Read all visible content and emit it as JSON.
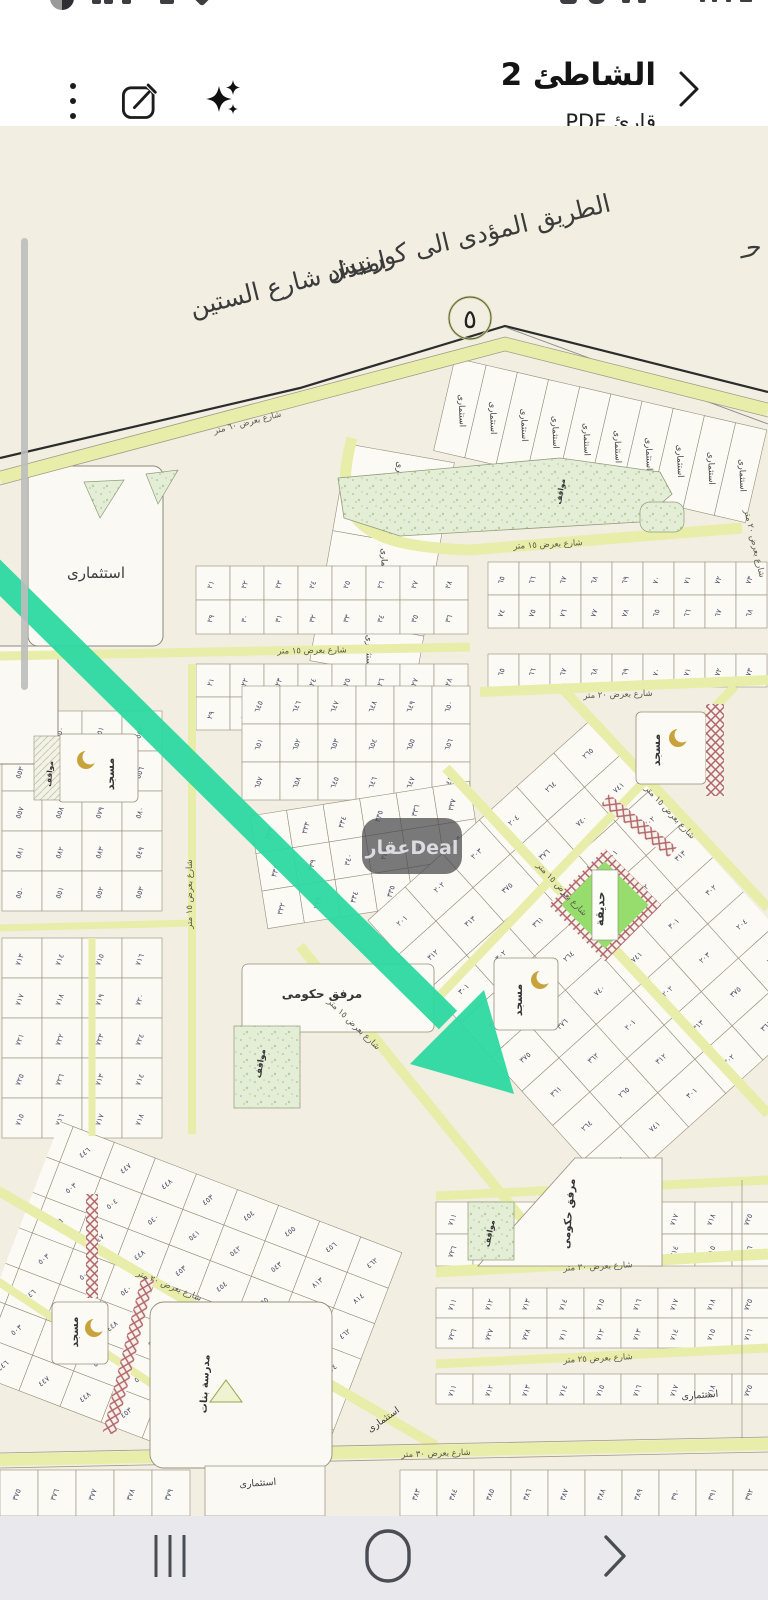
{
  "header": {
    "title": "الشاطئ 2",
    "subtitle": "قارئ PDF",
    "icons": [
      "back-chevron",
      "sparkles-ai",
      "compose-edit",
      "kebab-menu"
    ]
  },
  "bottom_nav": {
    "icons": [
      "recents",
      "home",
      "back"
    ]
  },
  "map": {
    "handwriting": [
      "الطريق المؤدى الى كورنيش",
      "امتداد شارع الستين"
    ],
    "circle_marker": "٥",
    "watermark": "عقارDeal",
    "colors": {
      "paper": "#f2eee1",
      "parcel": "#fbfaf5",
      "parcel_line": "#968e7c",
      "road_yellow": "#e9edaa",
      "park_green": "#e4eed7",
      "garden_green": "#97dd6d",
      "hatch_red": "#b2656c",
      "arrow_green": "#2ed9a1",
      "number_blue": "#4b4f66"
    },
    "labels": [
      {
        "t": "شارع بعرض ٦٠ متر",
        "x": 248,
        "y": 299,
        "r": -14.5,
        "c": "st"
      },
      {
        "t": "شارع بعرض ١٥ متر",
        "x": 548,
        "y": 421,
        "r": -3,
        "c": "st"
      },
      {
        "t": "شارع بعرض ١٥ متر",
        "x": 312,
        "y": 527,
        "r": -1,
        "c": "st"
      },
      {
        "t": "شارع بعرض ٢٠ متر",
        "x": 618,
        "y": 571,
        "r": -2,
        "c": "st"
      },
      {
        "t": "شارع بعرض ١٥ متر",
        "x": 560,
        "y": 765,
        "r": 47,
        "c": "st"
      },
      {
        "t": "شارع بعرض ١٥ متر",
        "x": 668,
        "y": 688,
        "r": 47,
        "c": "st"
      },
      {
        "t": "شارع بعرض ١٥ متر",
        "x": 352,
        "y": 900,
        "r": 44,
        "c": "st"
      },
      {
        "t": "شارع بعرض ١٥ متر",
        "x": 192,
        "y": 768,
        "r": -90,
        "c": "st",
        "s": 7.5
      },
      {
        "t": "شارع بعرض ٢٠ متر",
        "x": 752,
        "y": 418,
        "r": 77,
        "c": "st",
        "s": 7.5
      },
      {
        "t": "شارع بعرض ٣٠ متر",
        "x": 598,
        "y": 1143,
        "r": -3,
        "c": "st"
      },
      {
        "t": "شارع بعرض ٢٥ متر",
        "x": 598,
        "y": 1235,
        "r": -3,
        "c": "st"
      },
      {
        "t": "شارع بعرض ٣٠ متر",
        "x": 436,
        "y": 1330,
        "r": -2,
        "c": "st"
      },
      {
        "t": "شارع بعرض ٢٠ متر",
        "x": 168,
        "y": 1162,
        "r": 22,
        "c": "st"
      },
      {
        "t": "استثمارى",
        "x": 96,
        "y": 452,
        "s": 15,
        "c": "zn"
      },
      {
        "t": "استثمارى",
        "x": 385,
        "y": 1296,
        "s": 9.5,
        "r": -35,
        "c": "zn"
      },
      {
        "t": "استثمارى",
        "x": 258,
        "y": 1360,
        "s": 9.5,
        "r": -4,
        "c": "zn"
      },
      {
        "t": "استثمارى",
        "x": 700,
        "y": 1272,
        "s": 9.5,
        "r": -4,
        "c": "zn"
      },
      {
        "t": "مسجد",
        "x": 114,
        "y": 648,
        "r": -90,
        "s": 11,
        "c": "lm"
      },
      {
        "t": "مواقف",
        "x": 52,
        "y": 648,
        "r": -85,
        "s": 7.5,
        "c": "lm"
      },
      {
        "t": "مسجد",
        "x": 660,
        "y": 624,
        "r": -90,
        "s": 11,
        "c": "lm"
      },
      {
        "t": "مسجد",
        "x": 522,
        "y": 874,
        "r": -90,
        "s": 11,
        "c": "lm"
      },
      {
        "t": "مواقف",
        "x": 563,
        "y": 366,
        "r": -80,
        "s": 7.5,
        "c": "lm"
      },
      {
        "t": "مرفق حكومى",
        "x": 322,
        "y": 872,
        "s": 12,
        "c": "lm"
      },
      {
        "t": "مواقف",
        "x": 263,
        "y": 938,
        "r": -80,
        "s": 8.5,
        "c": "lm"
      },
      {
        "t": "حديقة",
        "x": 604,
        "y": 783,
        "r": -88,
        "s": 11.5,
        "c": "lm"
      },
      {
        "t": "مرفق حكومى",
        "x": 572,
        "y": 1088,
        "r": -85,
        "s": 10.5,
        "c": "lm"
      },
      {
        "t": "مواقف",
        "x": 492,
        "y": 1108,
        "r": -78,
        "s": 8,
        "c": "lm"
      },
      {
        "t": "مدرسة بنات",
        "x": 208,
        "y": 1258,
        "r": -87,
        "s": 10,
        "c": "lm"
      },
      {
        "t": "مسجد",
        "x": 78,
        "y": 1206,
        "r": -90,
        "s": 10.5,
        "c": "lm"
      },
      {
        "t": "حـ",
        "x": 752,
        "y": 130,
        "r": -13,
        "s": 20,
        "c": "hand"
      }
    ],
    "nums": {
      "n2": [
        "٦٥",
        "٦٦",
        "٦٧",
        "٦٨",
        "٦٩",
        "٧٠",
        "٧١",
        "٧٢",
        "٧٣",
        "٧٤",
        "٧٥",
        "٧٦",
        "٧٧",
        "٧٨"
      ],
      "n2b": [
        "٢١",
        "٢٢",
        "٢٣",
        "٢٤",
        "٢٥",
        "٢٦",
        "٢٧",
        "٢٨",
        "٢٩",
        "٣٠",
        "٣١",
        "٣٢",
        "٣٣",
        "٣٤",
        "٣٥",
        "٣٦"
      ],
      "n5": [
        "٥٤٩",
        "٥٥٠",
        "٥٥١",
        "٥٥٢",
        "٥٥٣",
        "٥٥٤",
        "٥٥٥",
        "٥٥٦",
        "٥٥٧",
        "٥٥٨",
        "٥٧٩",
        "٥٨٠",
        "٥٨١",
        "٥٨٢",
        "٥٨٣"
      ],
      "n7": [
        "٧١٣",
        "٧١٤",
        "٧١٥",
        "٧١٦",
        "٧١٧",
        "٧١٨",
        "٧١٩",
        "٧٢٠",
        "٧٢١",
        "٧٢٢",
        "٧٢٣",
        "٧٢٤",
        "٧٢٥",
        "٧٢٦"
      ],
      "n6": [
        "٦٤٥",
        "٦٤٦",
        "٦٤٧",
        "٦٤٨",
        "٦٤٩",
        "٦٥٠",
        "٦٥١",
        "٦٥٢",
        "٦٥٣",
        "٦٥٤",
        "٦٥٥",
        "٦٥٦",
        "٦٥٧",
        "٦٥٨"
      ],
      "n3": [
        "٣٣٢",
        "٣٣٣",
        "٣٣٤",
        "٣٣٥",
        "٣٣٦",
        "٣٣٧",
        "٣٣٨",
        "٣٣٩",
        "٣٤٠",
        "٣٤١",
        "٣٤٢",
        "٣٤٣"
      ],
      "nd": [
        "٢٠١",
        "٢٠٢",
        "٢٠٣",
        "٢٠٤",
        "٢٦٤",
        "٢٦٥",
        "٣١٢",
        "٣١٣",
        "٣٧٥",
        "٣٧٦",
        "٧٤٠",
        "٧٤١",
        "٣٠١",
        "٣٠٢",
        "٣٦١",
        "٣٦٢"
      ],
      "nbl": [
        "٤٤٥",
        "٤٤٦",
        "٤٤٧",
        "٤٤٨",
        "٤٥٣",
        "٤٥٤",
        "٤٥٥",
        "٤٥٦",
        "٤٦٢",
        "٤٦٣",
        "٥٠٣",
        "٥٠٤",
        "٥٤٠",
        "٥٤١",
        "٥٤٢",
        "٥٤٣",
        "٨١٣",
        "٨١٤"
      ],
      "nbr": [
        "٧١١",
        "٧١٢",
        "٧١٣",
        "٧١٤",
        "٧١٥",
        "٧١٦",
        "٧١٧",
        "٧١٨",
        "٧٢٥",
        "٧٢٦",
        "٧٢٧",
        "٧٢٨"
      ],
      "nbs": [
        "٣٨٣",
        "٣٨٤",
        "٣٨٥",
        "٣٨٦",
        "٣٨٧",
        "٣٨٨",
        "٣٨٩",
        "٣٩٠",
        "٣٩١",
        "٣٩٢"
      ],
      "nbsl": [
        "٣٧٥",
        "٣٧٦",
        "٣٧٧",
        "٣٧٨",
        "٣٧٩"
      ]
    },
    "grids": [
      {
        "n": "fan-right",
        "x": 455,
        "y": 232,
        "rows": 1,
        "cols": 10,
        "cw": 32,
        "ch": 95,
        "rot": 13,
        "cellLabel": "استثمارى",
        "clRot": 75
      },
      {
        "n": "strip-left",
        "x": 348,
        "y": 318,
        "rows": 5,
        "cols": 1,
        "cw": 108,
        "ch": 44,
        "rot": 10,
        "cellLabel": "استثمارى",
        "clRot": 80
      },
      {
        "n": "rows-right-1",
        "x": 488,
        "y": 436,
        "rows": 2,
        "cols": 9,
        "cw": 31,
        "ch": 33,
        "nums": "n2",
        "numRot": -70
      },
      {
        "n": "rows-center-1",
        "x": 196,
        "y": 440,
        "rows": 2,
        "cols": 8,
        "cw": 34,
        "ch": 34,
        "nums": "n2b",
        "numRot": -70
      },
      {
        "n": "rows-right-2",
        "x": 488,
        "y": 528,
        "rows": 1,
        "cols": 9,
        "cw": 31,
        "ch": 33,
        "nums": "n2",
        "numRot": -70
      },
      {
        "n": "rows-center-2",
        "x": 196,
        "y": 538,
        "rows": 2,
        "cols": 8,
        "cw": 34,
        "ch": 33,
        "nums": "n2b",
        "numRot": -70
      },
      {
        "n": "left-col-1",
        "x": 2,
        "y": 585,
        "rows": 5,
        "cols": 4,
        "cw": 40,
        "ch": 40,
        "nums": "n5",
        "numRot": -70
      },
      {
        "n": "left-col-2",
        "x": 2,
        "y": 812,
        "rows": 5,
        "cols": 4,
        "cw": 40,
        "ch": 40,
        "nums": "n7",
        "numRot": -70
      },
      {
        "n": "mid-block",
        "x": 242,
        "y": 560,
        "rows": 3,
        "cols": 6,
        "cw": 38,
        "ch": 38,
        "nums": "n6",
        "numRot": -70
      },
      {
        "n": "mid-tilt",
        "x": 250,
        "y": 690,
        "rows": 3,
        "cols": 6,
        "cw": 37,
        "ch": 38,
        "rot": -9,
        "nums": "n3",
        "numRot": -65
      },
      {
        "n": "diamond",
        "x": 470,
        "y": 640,
        "rows": 8,
        "cols": 6,
        "cw": 50,
        "ch": 46,
        "rot": -42,
        "rotCx": 620,
        "rotCy": 850,
        "nums": "nd",
        "numRot": 0,
        "clip": "clip-diamond"
      },
      {
        "n": "bottom-left",
        "x": -30,
        "y": 1040,
        "rows": 7,
        "cols": 9,
        "cw": 44,
        "ch": 38,
        "rot": 21,
        "rotCx": 150,
        "rotCy": 1180,
        "nums": "nbl",
        "numRot": -60,
        "clip": "clip-bl"
      },
      {
        "n": "bottom-right-1",
        "x": 436,
        "y": 1076,
        "rows": 2,
        "cols": 9,
        "cw": 37,
        "ch": 32,
        "nums": "nbr",
        "numRot": -70
      },
      {
        "n": "bottom-right-2",
        "x": 436,
        "y": 1162,
        "rows": 2,
        "cols": 9,
        "cw": 37,
        "ch": 30,
        "nums": "nbr",
        "numRot": -70
      },
      {
        "n": "bottom-right-3",
        "x": 436,
        "y": 1248,
        "rows": 1,
        "cols": 9,
        "cw": 37,
        "ch": 30,
        "nums": "nbr",
        "numRot": -70
      },
      {
        "n": "bottom-strip-right",
        "x": 400,
        "y": 1344,
        "rows": 1,
        "cols": 10,
        "cw": 37,
        "ch": 46,
        "nums": "nbs",
        "numRot": -70
      },
      {
        "n": "bottom-strip-left",
        "x": 0,
        "y": 1344,
        "rows": 1,
        "cols": 5,
        "cw": 38,
        "ch": 46,
        "nums": "nbsl",
        "numRot": -70
      }
    ]
  }
}
